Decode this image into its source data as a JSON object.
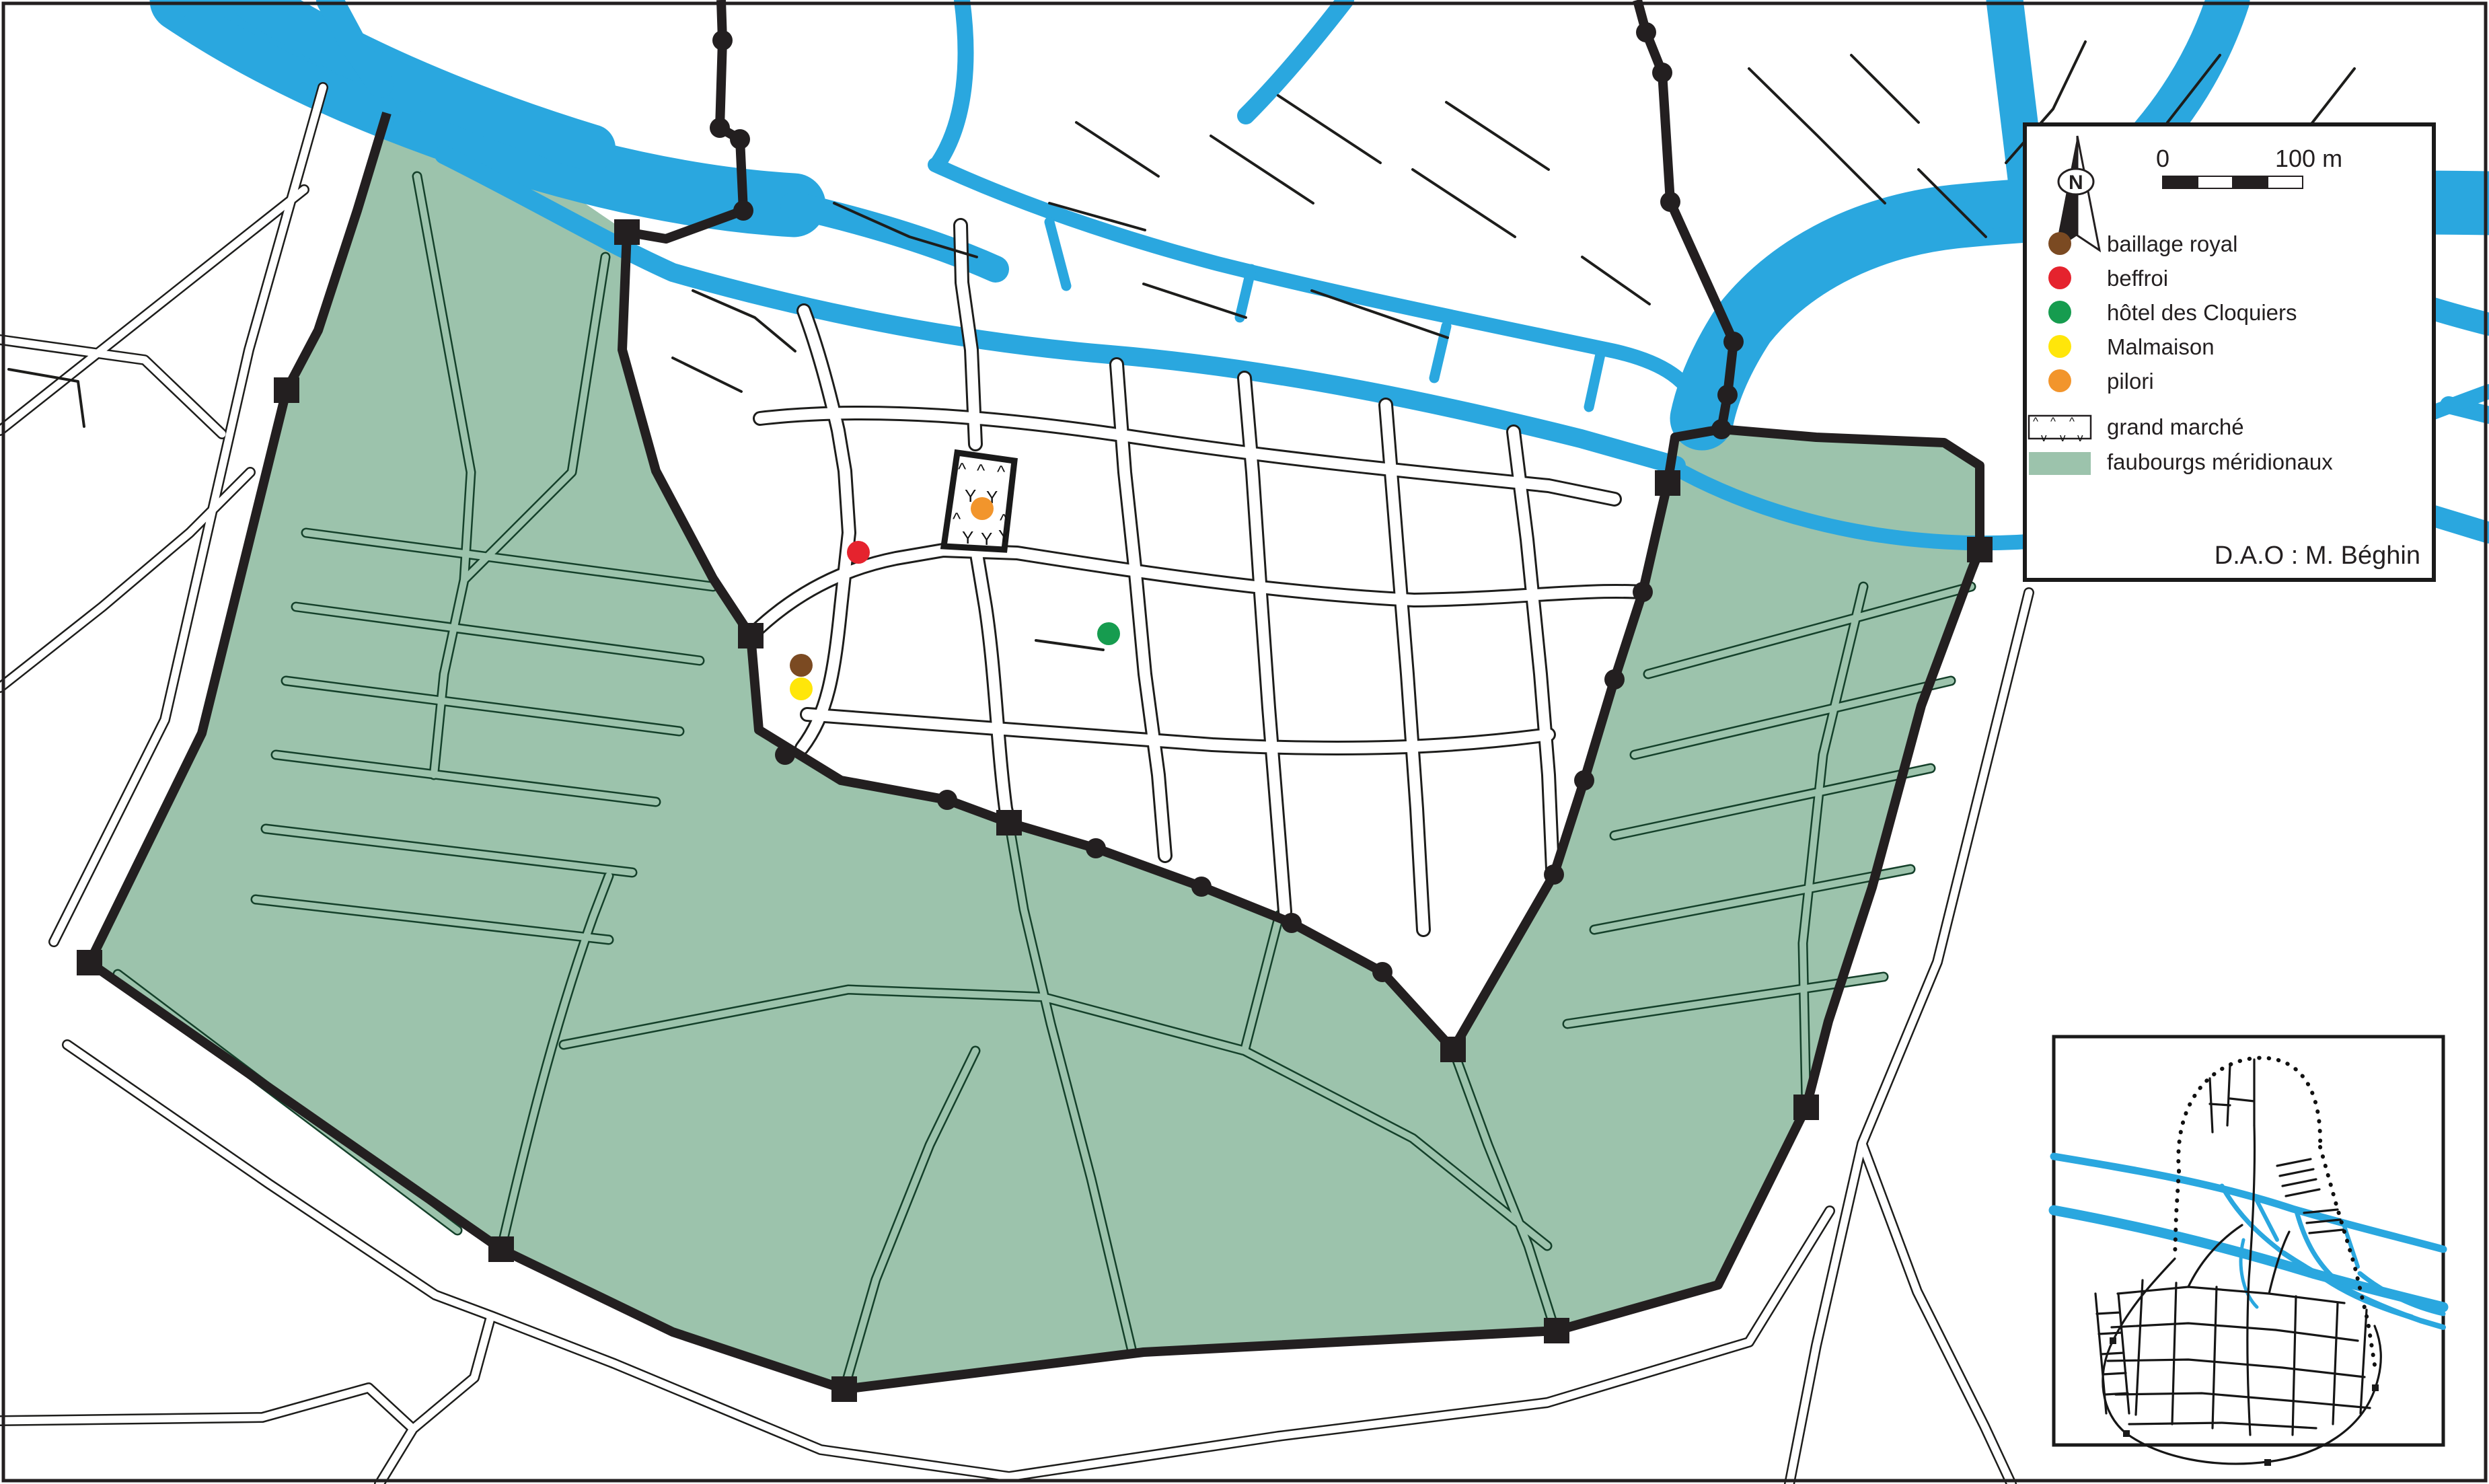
{
  "map": {
    "credit": "D.A.O : M. Béghin",
    "north_label": "N",
    "scale_bar": {
      "start_label": "0",
      "end_label": "100 m"
    },
    "legend": {
      "items": [
        {
          "id": "baillage-royal",
          "label": "baillage royal",
          "type": "dot",
          "color": "#7b4a22"
        },
        {
          "id": "beffroi",
          "label": "beffroi",
          "type": "dot",
          "color": "#e5232e"
        },
        {
          "id": "hotel-des-cloquiers",
          "label": "hôtel des Cloquiers",
          "type": "dot",
          "color": "#169c4f"
        },
        {
          "id": "malmaison",
          "label": "Malmaison",
          "type": "dot",
          "color": "#ffe60a"
        },
        {
          "id": "pilori",
          "label": "pilori",
          "type": "dot",
          "color": "#f2952c"
        },
        {
          "id": "grand-marche",
          "label": "grand marché",
          "type": "hatch-swatch"
        },
        {
          "id": "faubourgs-meridionaux",
          "label": "faubourgs méridionaux",
          "type": "fill-swatch",
          "color": "#9cc3ac"
        }
      ]
    },
    "markers": [
      {
        "id": "marker-baillage-royal",
        "label": "baillage royal",
        "color": "#7b4a22"
      },
      {
        "id": "marker-beffroi",
        "label": "beffroi",
        "color": "#e5232e"
      },
      {
        "id": "marker-hotel-des-cloquiers",
        "label": "hôtel des Cloquiers",
        "color": "#169c4f"
      },
      {
        "id": "marker-malmaison",
        "label": "Malmaison",
        "color": "#ffe60a"
      },
      {
        "id": "marker-pilori",
        "label": "pilori",
        "color": "#f2952c"
      }
    ],
    "colors": {
      "water": "#2aa7df",
      "faubourg": "#9cc3ac",
      "wall": "#231f20",
      "road_casing": "#1d1d1b",
      "green_road": "#14402a",
      "background": "#ffffff",
      "text": "#231f20"
    }
  }
}
